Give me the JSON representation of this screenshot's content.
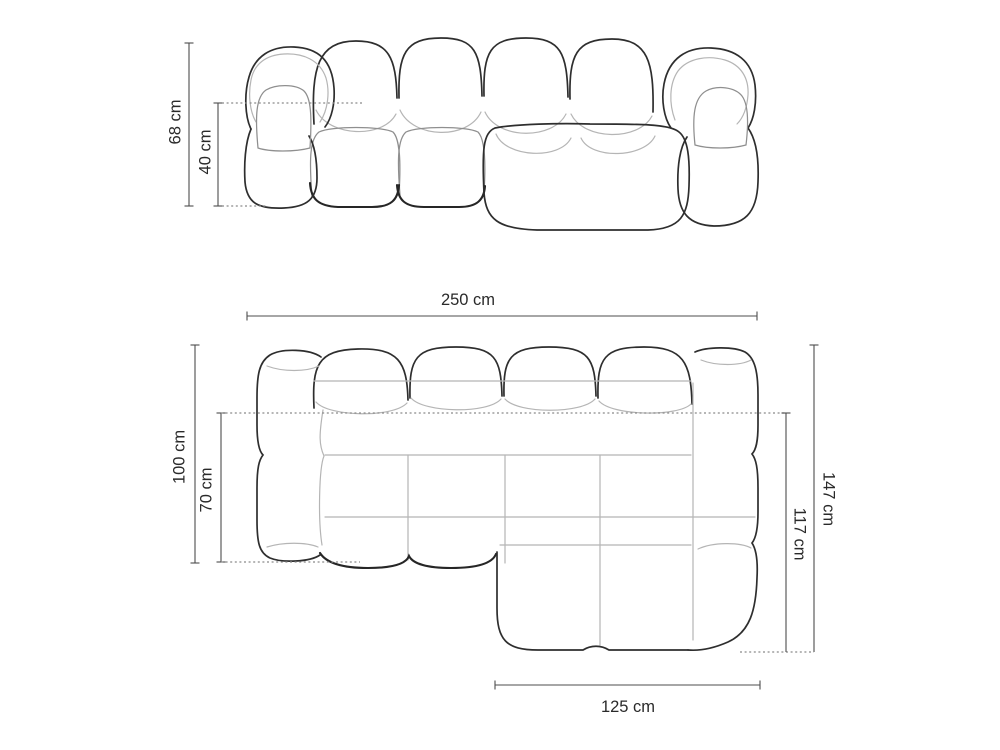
{
  "front_view": {
    "dimensions": {
      "total_height": "68 cm",
      "seat_height": "40 cm"
    }
  },
  "top_view": {
    "dimensions": {
      "total_width": "250 cm",
      "total_depth": "100 cm",
      "seat_depth": "70 cm",
      "chaise_total_depth": "147 cm",
      "chaise_inner_depth": "117 cm",
      "chaise_width": "125 cm"
    }
  },
  "colors": {
    "background": "#ffffff",
    "outline": "#2e2e2e",
    "seam": "#b5b5b5",
    "dimension_line": "#4d4d4d",
    "dotted_line": "#8a8a8a",
    "text": "#2a2a2a"
  }
}
